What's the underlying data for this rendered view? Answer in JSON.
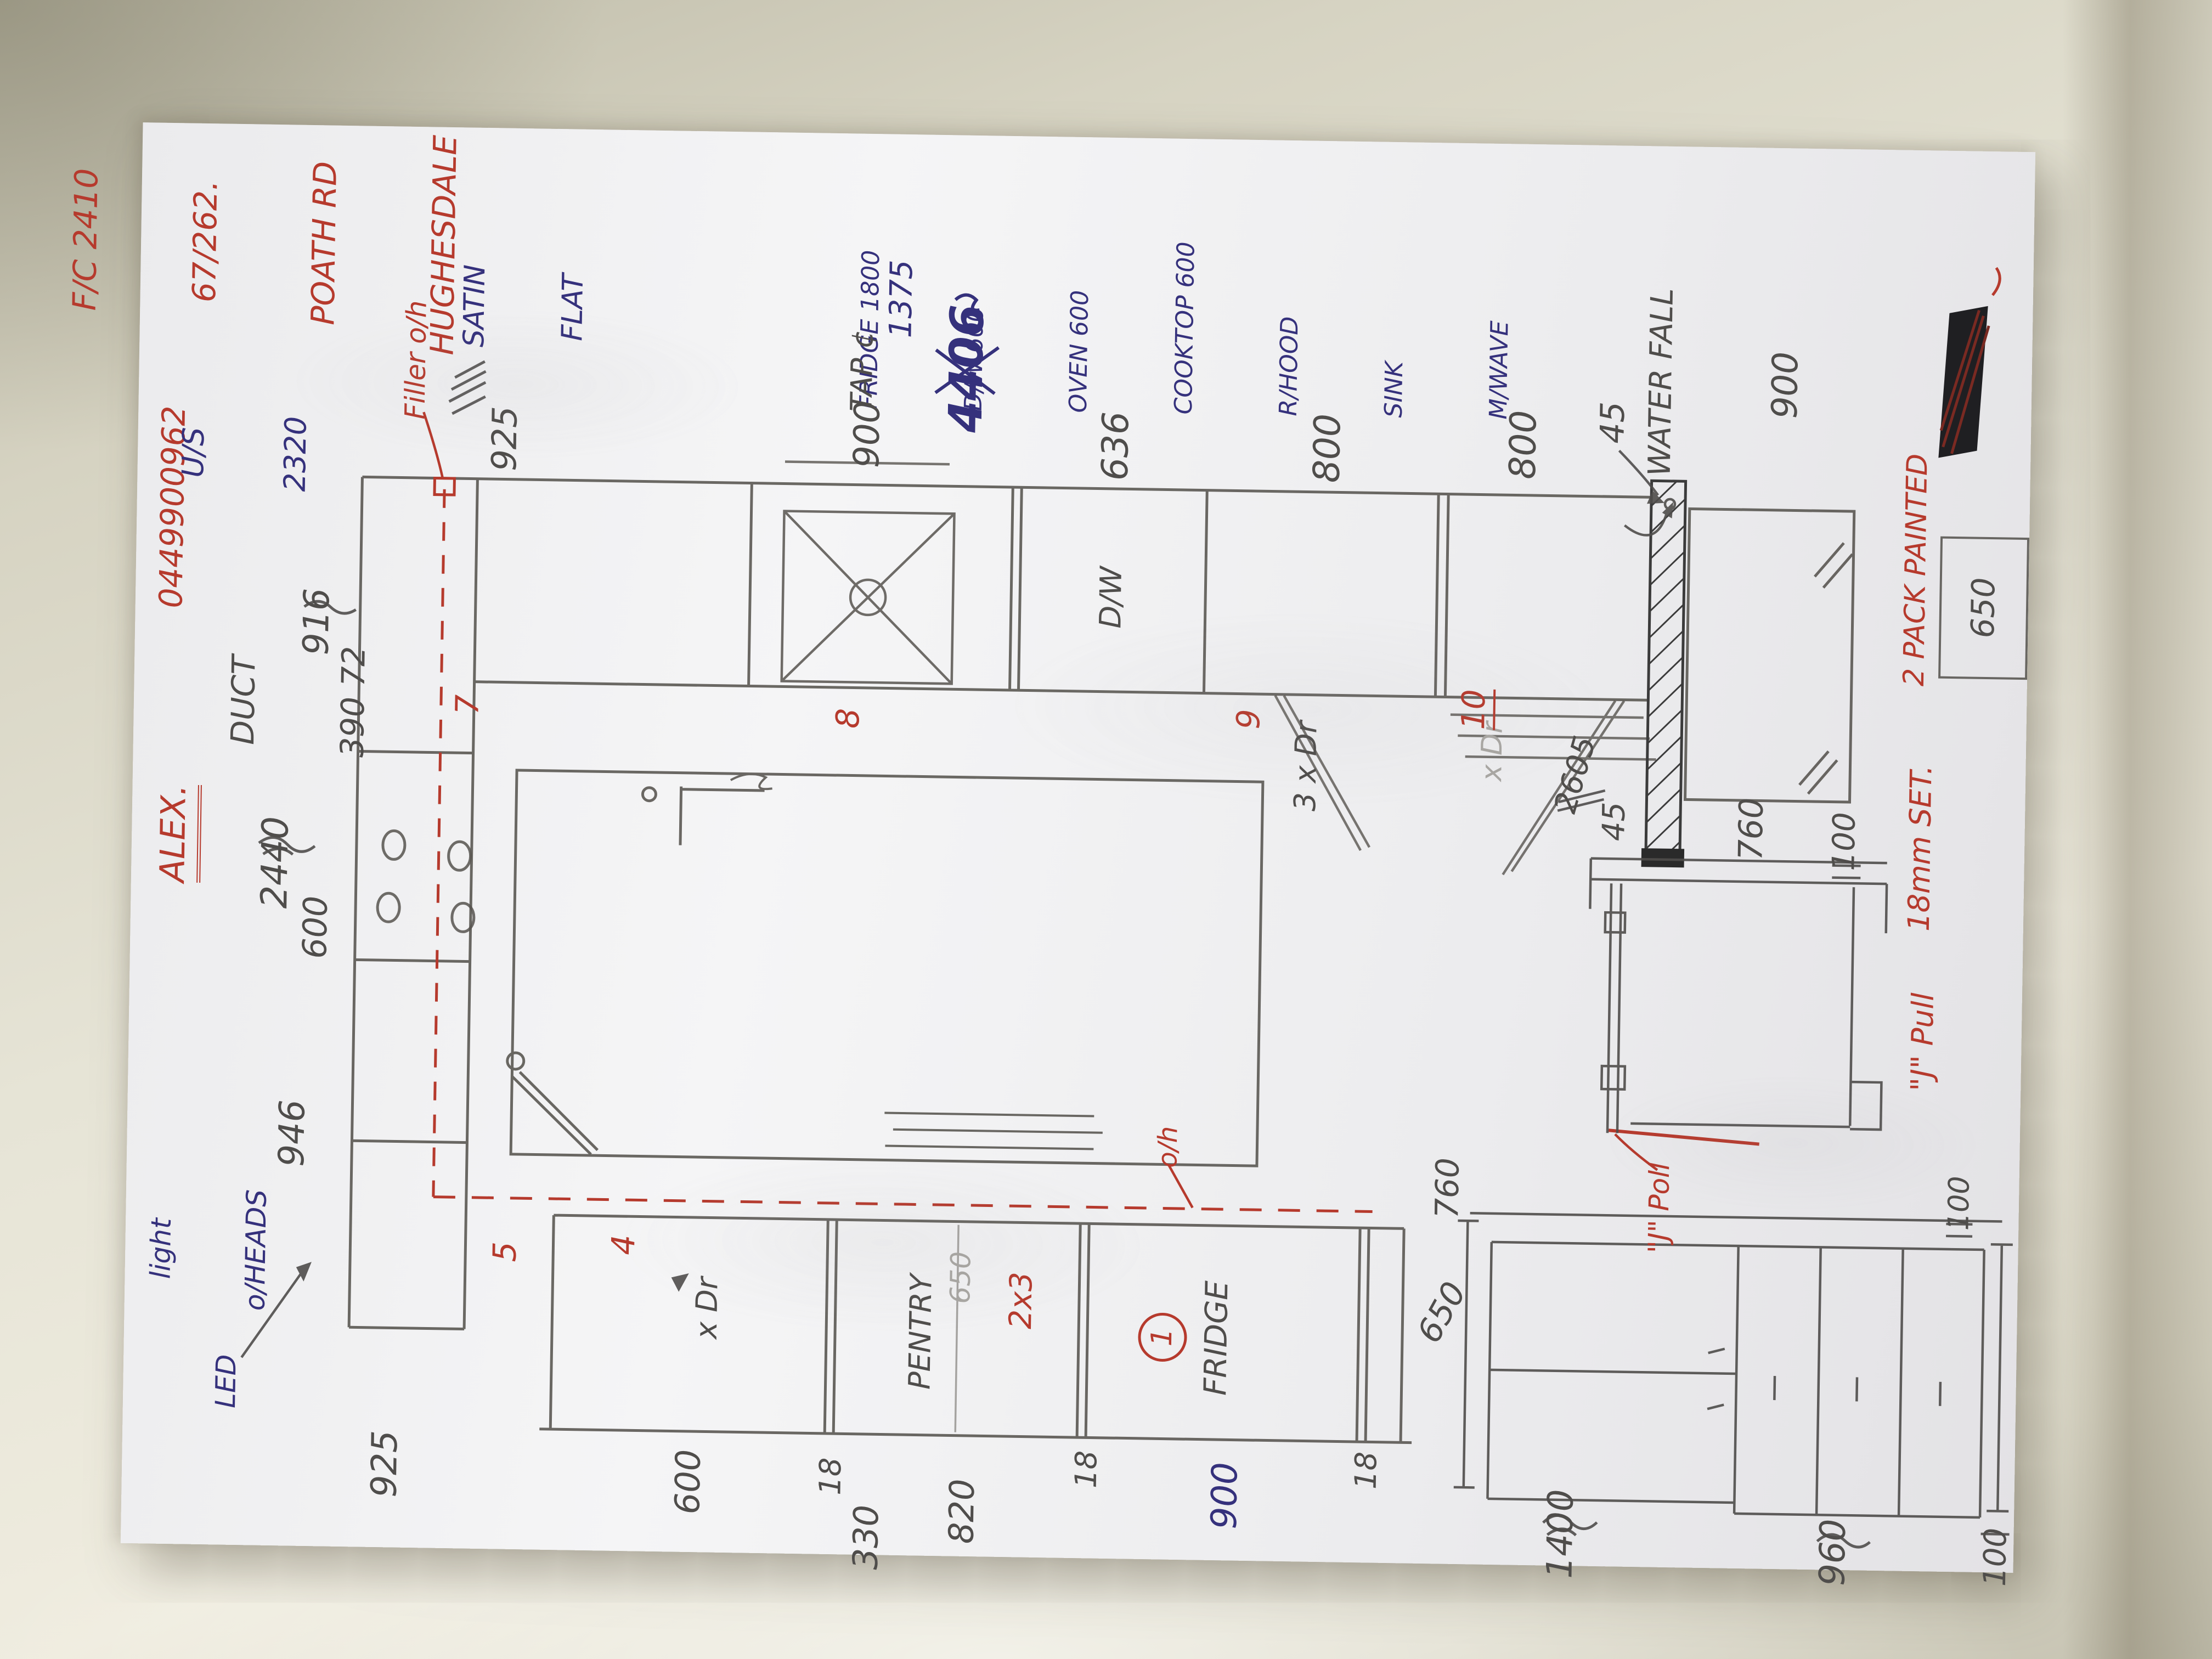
{
  "annotations": {
    "contact": [
      "F/C 2410",
      "67/262.",
      "POATH RD",
      "HUGHESDALE"
    ],
    "phone": "0449900962",
    "client": "ALEX.",
    "underside": {
      "line1": "U/S",
      "line2": "2320"
    },
    "duct": {
      "line1": "DUCT",
      "line2": "390 72"
    },
    "filler": "Filler o/h",
    "satin": {
      "line1": "SATIN",
      "line2": "FLAT"
    },
    "tap": "TAP ¢",
    "tap_size": "1375",
    "waterfall": "WATER FALL",
    "oh": "o/h",
    "led": {
      "line1": "light",
      "line2": "o/HEADS",
      "line3": "LED"
    },
    "jpoll": "\"J\" Poll",
    "jpull": "\"J\" Pull",
    "set18": "18mm SET.",
    "pack2": "2 PACK PAINTED"
  },
  "appliances": [
    "FRIDGE 1800",
    "D/W 600",
    "OVEN 600",
    "COOKTOP 600",
    "R/HOOD",
    "SINK",
    "M/WAVE"
  ],
  "cabinet_labels": {
    "dw": "D/W",
    "dr3": "3 x Dr",
    "xdr_ghost": "x Dr",
    "xdr4": "x Dr",
    "pantry": "PENTRY",
    "pantry_650": "650",
    "fridge": "FRIDGE"
  },
  "red_numbers": {
    "n1": "1",
    "n2x3": "2x3",
    "n4": "4",
    "n5": "5",
    "n7": "7",
    "n8": "8",
    "n9": "9",
    "n10": "10"
  },
  "dims": {
    "d2440": "2440",
    "d600_left": "600",
    "d916": "916",
    "d946": "946",
    "d925_bottom": "925",
    "d925_top": "925",
    "d900_sink": "900",
    "d636": "636",
    "d800_a": "800",
    "d800_b": "800",
    "d45_panel": "45",
    "d900_tall": "900",
    "d2605": "2605",
    "total_4406": "4406",
    "d600_base": "600",
    "d18_a": "18",
    "d330": "330",
    "d820": "820",
    "d18_b": "18",
    "d900_fridge": "900",
    "d18_c": "18",
    "d650_fridge": "650",
    "detail_45": "45",
    "detail_760": "760",
    "detail_100": "100",
    "col_650": "650",
    "elev_760": "760",
    "elev_100_top": "100",
    "elev_1400": "1400",
    "elev_960": "960",
    "elev_100_bottom": "100"
  },
  "colors": {
    "pencil": "#4f4d4b",
    "red": "#b63a2d",
    "blue": "#35317c",
    "paper": "#f0f0f2"
  }
}
